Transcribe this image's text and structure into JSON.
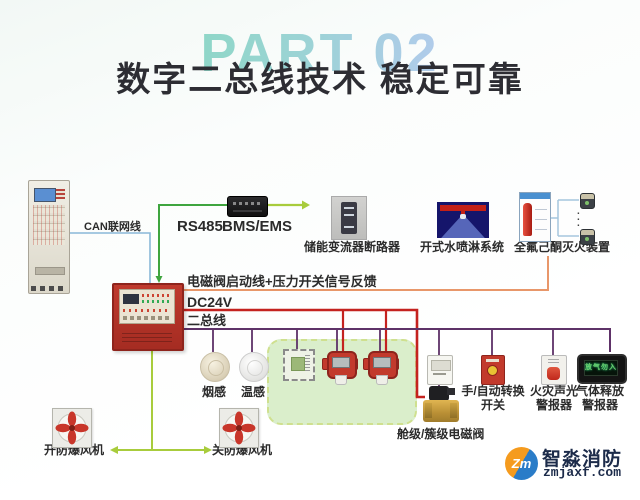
{
  "title": {
    "part": "PART 02",
    "heading": "数字二总线技术  稳定可靠"
  },
  "colors": {
    "line_red": "#c4221f",
    "line_purple": "#5e3268",
    "line_orange": "#e8976a",
    "line_green": "#3fa53f",
    "line_yellow_green": "#a8cc3c",
    "line_blue": "#8ab8d8",
    "panel_red": "#bf3a2d",
    "zone_green": "#daeecb"
  },
  "network": {
    "can_label": "CAN联网线",
    "rs485_label": "RS485",
    "bms_label": "BMS/EMS"
  },
  "top_devices": {
    "breaker_label": "储能变流器断路器",
    "water_label": "开式水喷淋系统",
    "gas_device_label": "全氟己酮灭火装置"
  },
  "bus": {
    "valve_feedback_label": "电磁阀启动线+压力开关信号反馈",
    "dc24v_label": "DC24V",
    "two_bus_label": "二总线"
  },
  "detectors": {
    "smoke_label": "烟感",
    "temp_label": "温感",
    "composite_label_line1": "三合一",
    "composite_label_line2": "复合探测器",
    "co_label": "CO",
    "h2_label": "H2"
  },
  "right_devices": {
    "valve_label": "舱级/簇级电磁阀",
    "switch_label_line1": "手/自动转换",
    "switch_label_line2": "开关",
    "sound_alarm_label_line1": "火灾声光",
    "sound_alarm_label_line2": "警报器",
    "gas_alarm_label_line1": "气体释放",
    "gas_alarm_label_line2": "警报器",
    "gas_alarm_screen_text": "放气勿入"
  },
  "fans": {
    "open_label": "开防爆风机",
    "close_label": "关防爆风机"
  },
  "logo": {
    "name": "智淼消防",
    "url": "zmjaxf.com",
    "monogram": "Zm"
  }
}
